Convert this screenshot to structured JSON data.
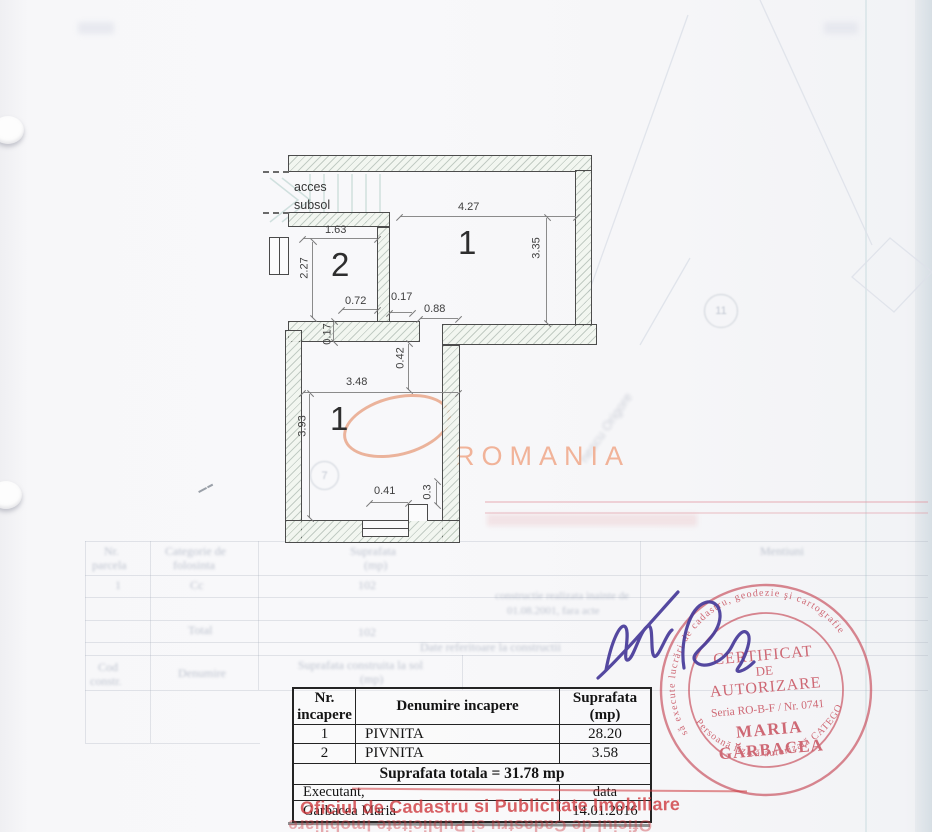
{
  "plan": {
    "access_line1": "acces",
    "access_line2": "subsol",
    "room_labels": {
      "upper": "1",
      "lower": "1",
      "small": "2"
    },
    "dims": {
      "w163": "1.63",
      "h227": "2.27",
      "w427": "4.27",
      "h335": "3.35",
      "w072": "0.72",
      "w017": "0.17",
      "w088": "0.88",
      "h017": "0.17",
      "h042": "0.42",
      "w348": "3.48",
      "h393": "3.93",
      "w041": "0.41",
      "h03": "0.3"
    }
  },
  "watermark": {
    "text": "ROMANIA",
    "color": "#edb094"
  },
  "table": {
    "headers": {
      "col1_line1": "Nr.",
      "col1_line2": "incapere",
      "col2": "Denumire incapere",
      "col3_line1": "Suprafata",
      "col3_line2": "(mp)"
    },
    "rows": [
      {
        "nr": "1",
        "name": "PIVNITA",
        "area": "28.20"
      },
      {
        "nr": "2",
        "name": "PIVNITA",
        "area": "3.58"
      }
    ],
    "total": "Suprafata totala = 31.78 mp",
    "executant_label": "Executant,",
    "executant_name": "Garbacea Maria",
    "date_label": "data",
    "date_value": "14.01.2016"
  },
  "round_stamp": {
    "ring_top": "să execute lucrări de cadastru, geodezie şi cartografie",
    "ring_bottom": "Persoană fizică autorizată   CATEGORIA A",
    "line1": "CERTIFICAT",
    "line2": "DE",
    "line3": "AUTORIZARE",
    "serial": "Seria RO-B-F / Nr. 0741",
    "name_line1": "MARIA",
    "name_line2": "GĂRBACEA",
    "color": "#c84f5d"
  },
  "office_stamp": {
    "text": "Oficiul de Cadastru si Publicitate Imobiliare",
    "mirrored_text": "Oficiul de Cadastru si Publicitate Imobiliare"
  },
  "ghost": {
    "bleedthrough_illegible": true,
    "a_col1a": "Nr.",
    "a_col1b": "parcela",
    "a_col2a": "Categorie de",
    "a_col2b": "folosinta",
    "a_col3a": "Suprafata",
    "a_col3b": "(mp)",
    "a_col4": "Mentiuni",
    "a_r1c1": "1",
    "a_r1c2": "Cc",
    "a_r1c3": "102",
    "a_m1": "constructie realizata inainte de",
    "a_m2": "01.08.2001, fara acte",
    "a_total": "Total",
    "a_totalv": "102",
    "b_title": "Date referitoare la constructii",
    "b_col1a": "Cod",
    "b_col1b": "constr.",
    "b_col2": "Denumire",
    "b_col3a": "Suprafata construita la sol",
    "b_col3b": "(mp)",
    "diag_text": "nescu Origore",
    "circle1": "7",
    "circle2": "11"
  }
}
